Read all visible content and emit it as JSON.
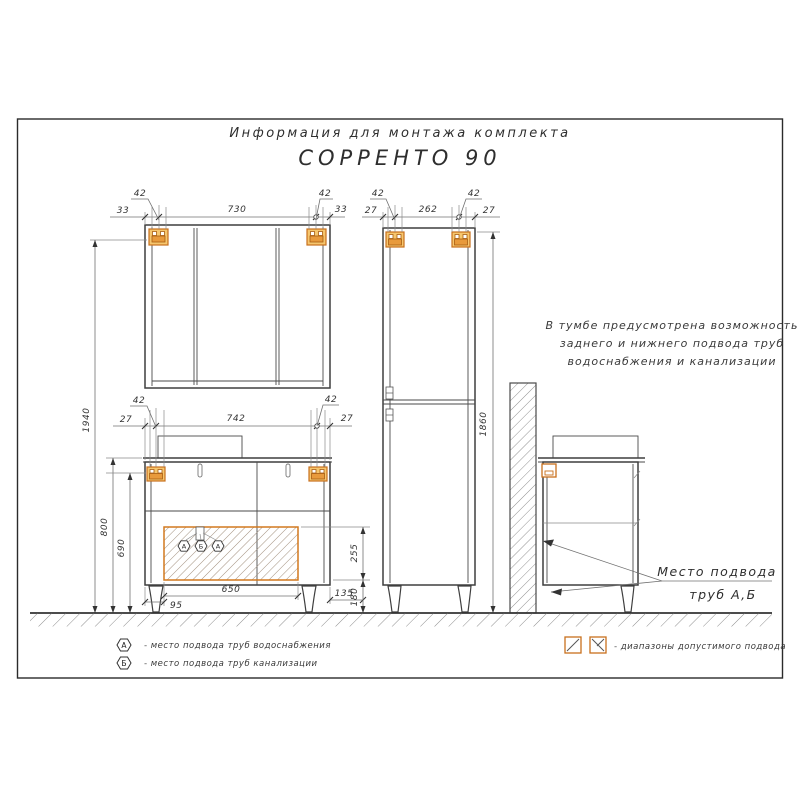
{
  "sheet": {
    "title_line1": "Информация для монтажа комплекта",
    "title_line2": "СОРРЕНТО 90"
  },
  "mirror_cabinet": {
    "dims": {
      "offset_left": "33",
      "bracket_left": "42",
      "between_brackets": "730",
      "bracket_right": "42",
      "offset_right": "33"
    }
  },
  "tall_cabinet": {
    "dims": {
      "offset_left": "27",
      "bracket_left": "42",
      "between_brackets": "262",
      "bracket_right": "42",
      "offset_right": "27",
      "height": "1860"
    }
  },
  "vanity": {
    "dims": {
      "offset_left": "27",
      "bracket_left": "42",
      "between_brackets": "742",
      "bracket_right": "42",
      "offset_right": "27",
      "total_height": "1940",
      "top_height": "800",
      "bracket_height": "690",
      "zone_width": "650",
      "zone_offset_left": "95",
      "zone_offset_right": "135",
      "zone_height": "255",
      "zone_bottom": "180"
    },
    "badge_a": "А",
    "badge_b": "Б"
  },
  "note": {
    "line1": "В тумбе предусмотрена возможность",
    "line2": "заднего и нижнего подвода труб",
    "line3": "водоснабжения и канализации"
  },
  "pointer": {
    "line1": "Место подвода",
    "line2": "труб А,Б"
  },
  "legend": {
    "items": [
      {
        "symbol": "А",
        "label": "- место подвода труб водоснабжения"
      },
      {
        "symbol": "Б",
        "label": "- место подвода труб канализации"
      }
    ],
    "ranges_label": "- диапазоны допустимого подвода"
  },
  "colors": {
    "accent_orange": "#D2791E",
    "bracket_fill": "#F6C66E",
    "line": "#3F3F3F",
    "dim_line": "#707070"
  }
}
